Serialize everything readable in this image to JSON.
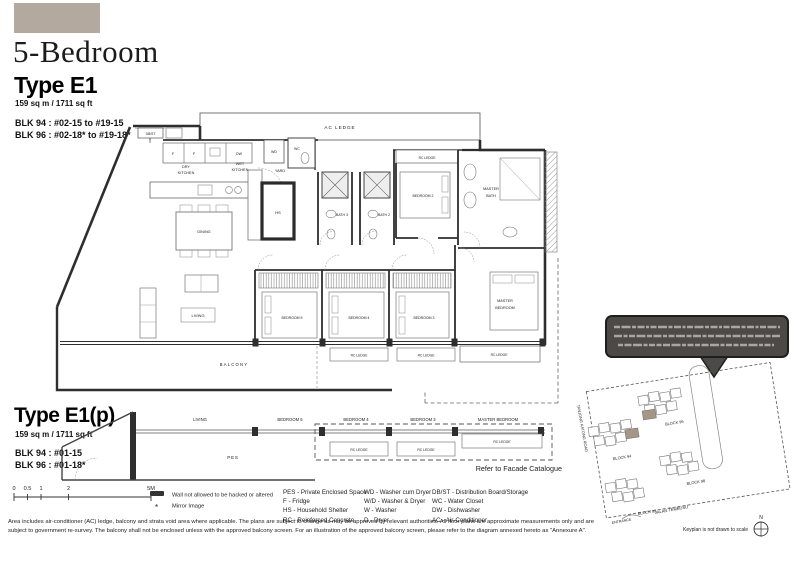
{
  "header": {
    "title": "5-Bedroom",
    "swatch_color": "#b3a99e"
  },
  "unit_types": {
    "e1": {
      "name": "Type E1",
      "area": "159 sq m / 1711 sq ft",
      "blk1": "BLK 94 : #02-15 to #19-15",
      "blk2": "BLK 96 : #02-18* to #19-18*"
    },
    "e1p": {
      "name": "Type E1(p)",
      "area": "159 sq m / 1711 sq ft",
      "blk1": "BLK 94 : #01-15",
      "blk2": "BLK 96 : #01-18*"
    }
  },
  "plan": {
    "labels": {
      "db_st": "DB/ST",
      "ac_ledge": "AC LEDGE",
      "fridge": "F",
      "dw": "DW",
      "wd": "WD",
      "wc": "WC",
      "dry_l1": "DRY",
      "dry_l2": "KITCHEN",
      "wet_l1": "WET",
      "wet_l2": "KITCHEN",
      "yard": "YARD",
      "rc_ledge": "RC LEDGE",
      "hs": "HS",
      "bath3": "BATH 3",
      "bath2": "BATH 2",
      "bedroom2": "BEDROOM 2",
      "mbath_l1": "MASTER",
      "mbath_l2": "BATH",
      "dining": "DINING",
      "living": "LIVING",
      "bedroom5": "BEDROOM 5",
      "bedroom4": "BEDROOM 4",
      "bedroom3": "BEDROOM 3",
      "mbed_l1": "MASTER",
      "mbed_l2": "BEDROOM",
      "balcony": "BALCONY"
    }
  },
  "plan_p": {
    "living": "LIVING",
    "bedroom5": "BEDROOM 5",
    "bedroom4": "BEDROOM 4",
    "bedroom3": "BEDROOM 3",
    "master_bedroom": "MASTER BEDROOM",
    "pes": "PES",
    "rc_ledge": "RC LEDGE",
    "facade_note": "Refer to Facade Catalogue"
  },
  "scale_bar": {
    "ticks": [
      "0",
      "0.5",
      "1",
      "2",
      "5M"
    ]
  },
  "plan_legend": {
    "wall": "Wall not allowed to be hacked or altered",
    "mirror_symbol": "*",
    "mirror": "Mirror Image"
  },
  "abbreviations": {
    "col1": [
      "PES - Private Enclosed Space",
      "F - Fridge",
      "HS - Household Shelter",
      "RC - Reinforced Concrete"
    ],
    "col2": [
      "WD - Washer cum Dryer",
      "W/D - Washer & Dryer",
      "W - Washer",
      "D - Dryer"
    ],
    "col3": [
      "DB/ST - Distribution Board/Storage",
      "WC - Water Closet",
      "DW - Dishwasher",
      "AC - Air-Conditioner"
    ]
  },
  "disclaimer": {
    "line1": "Area includes air-conditioner (AC) ledge, balcony and strata void area where applicable. The plans are subject to change as may be approved by relevant authorities. All floor plans are approximate measurements only and are",
    "line2": "subject to government re-survey. The balcony shall not be enclosed unless with the approved balcony screen. For an illustration of the approved balcony screen, please refer to the diagram annexed hereto as \"Annexure A\"."
  },
  "keyplan": {
    "block94": "BLOCK 94",
    "block96": "BLOCK 96",
    "block92": "BLOCK 92",
    "block98": "BLOCK 98",
    "road_left": "TANJONG KATONG ROAD",
    "road_bottom": "JALAN TEMBUSU",
    "entrance": "ENTRANCE",
    "compass": "N",
    "note": "Keyplan is not drawn to scale",
    "highlight_color": "#a69784"
  }
}
